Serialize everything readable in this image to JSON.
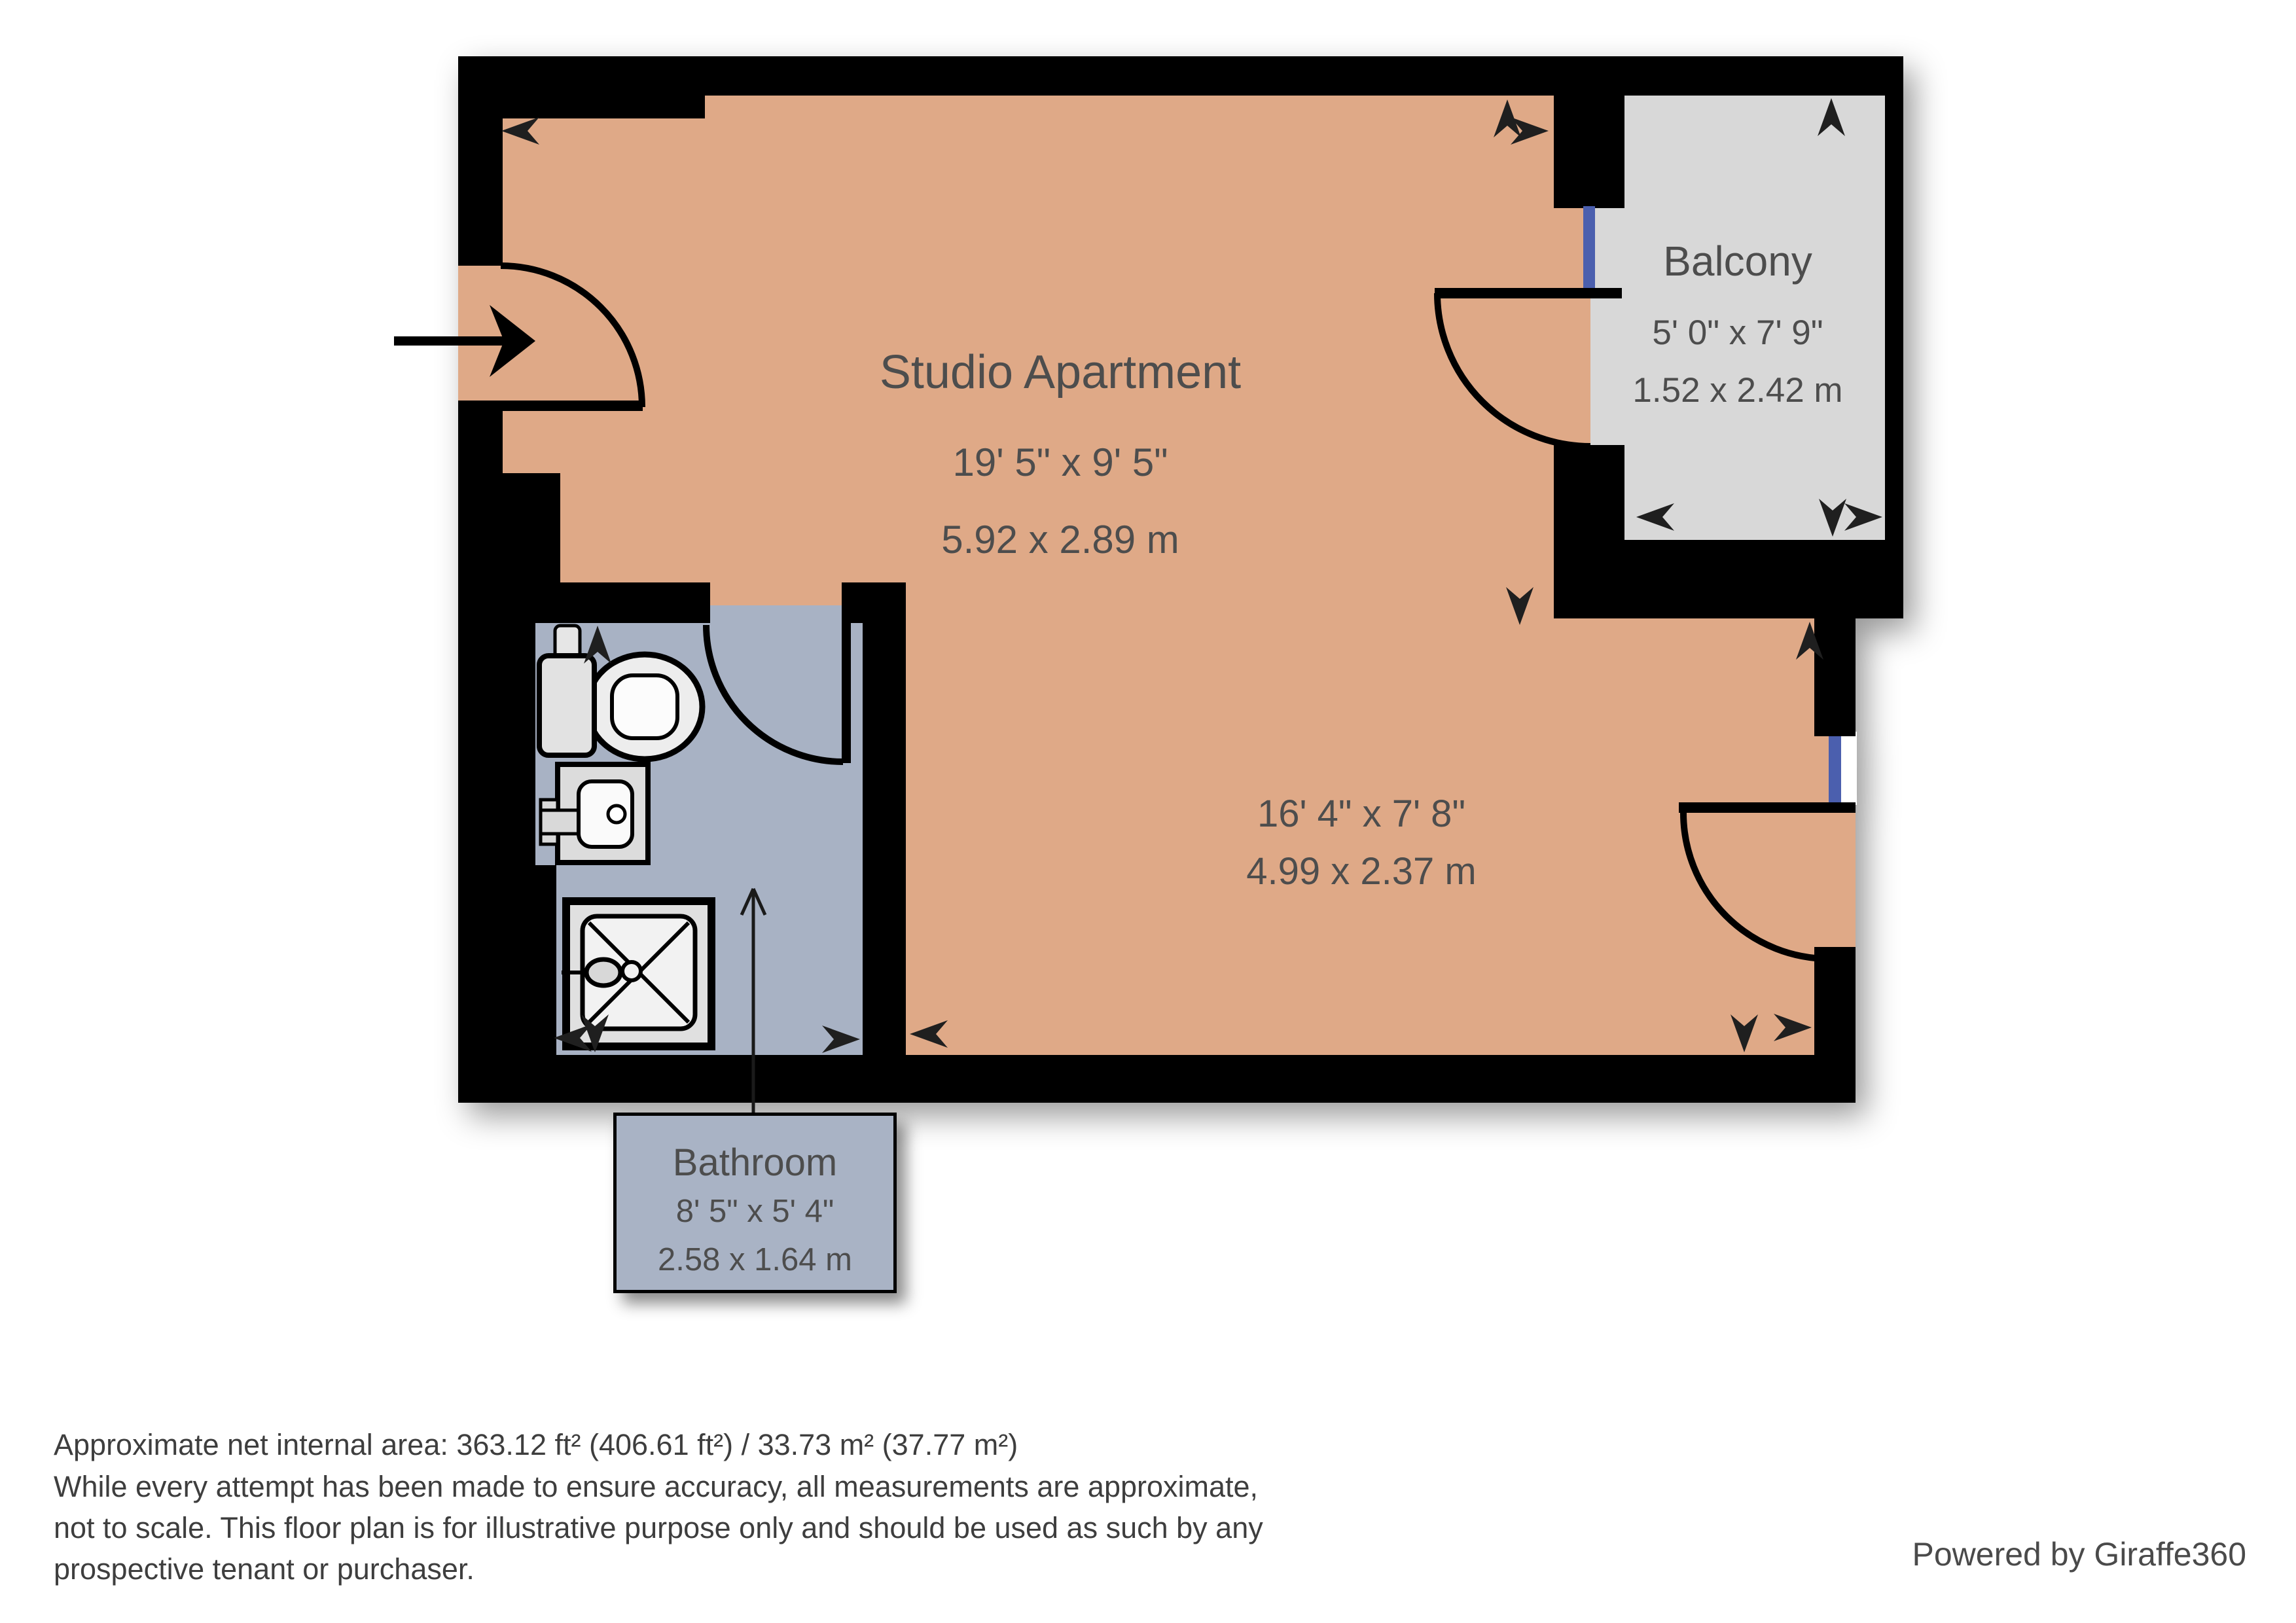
{
  "plan": {
    "rooms": [
      {
        "name": "Studio Apartment",
        "dims_imperial": "19' 5\" x 9' 5\"",
        "dims_metric": "5.92 x 2.89 m"
      },
      {
        "name": "",
        "dims_imperial": "16' 4\" x 7' 8\"",
        "dims_metric": "4.99 x 2.37 m"
      },
      {
        "name": "Balcony",
        "dims_imperial": "5' 0\" x 7' 9\"",
        "dims_metric": "1.52 x 2.42 m"
      },
      {
        "name": "Bathroom",
        "dims_imperial": "8' 5\" x 5' 4\"",
        "dims_metric": "2.58 x 1.64 m"
      }
    ],
    "fixtures": [
      "toilet",
      "sink",
      "shower"
    ],
    "colors": {
      "floor": "#dfa987",
      "bathroom_floor": "#a8b2c4",
      "balcony_floor": "#d8d8d8",
      "wall": "#000000",
      "window": "#4b5fae",
      "room_text": "#4d4d4d",
      "label_box_fill": "#a9b3c5"
    }
  },
  "footer": {
    "line1": "Approximate net internal area: 363.12 ft² (406.61 ft²) / 33.73 m² (37.77 m²)",
    "line2": "While every attempt has been made to ensure accuracy, all measurements are approximate,",
    "line3": "not to scale. This floor plan is for illustrative purpose only and should be used as such by any",
    "line4": "prospective tenant or purchaser.",
    "powered_by": "Powered by Giraffe360"
  }
}
